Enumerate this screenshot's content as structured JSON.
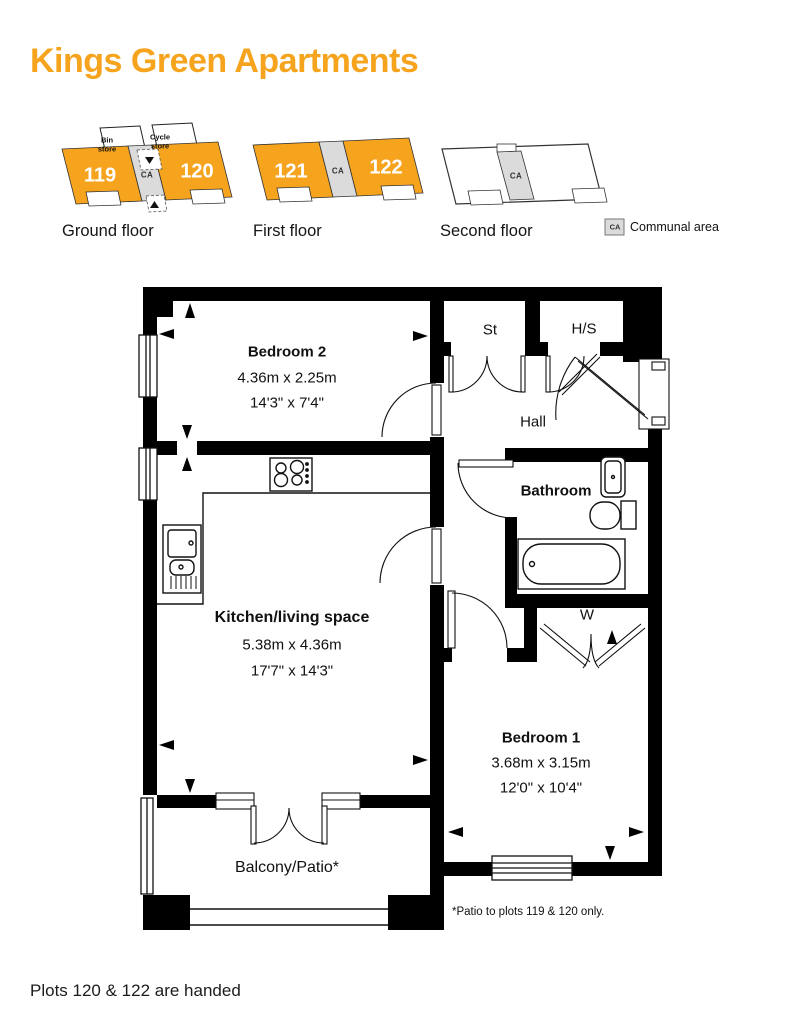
{
  "title": "Kings Green Apartments",
  "colors": {
    "accent": "#F6A41E",
    "communal": "#DBDBDB",
    "wall": "#000000"
  },
  "floor_key": {
    "ground": {
      "label": "Ground floor",
      "plot_left": "119",
      "plot_right": "120",
      "ca": "CA",
      "bin_store": "Bin store",
      "cycle_store": "Cycle store"
    },
    "first": {
      "label": "First floor",
      "plot_left": "121",
      "plot_right": "122",
      "ca": "CA"
    },
    "second": {
      "label": "Second floor",
      "ca": "CA"
    }
  },
  "legend": {
    "ca": "CA",
    "label": "Communal area"
  },
  "plan": {
    "bedroom2": {
      "name": "Bedroom 2",
      "metric": "4.36m x 2.25m",
      "imperial": "14'3\" x 7'4\""
    },
    "st": "St",
    "hs": "H/S",
    "hall": "Hall",
    "bathroom": "Bathroom",
    "w": "W",
    "kitchen": {
      "name": "Kitchen/living space",
      "metric": "5.38m x 4.36m",
      "imperial": "17'7\" x 14'3\""
    },
    "bedroom1": {
      "name": "Bedroom 1",
      "metric": "3.68m x 3.15m",
      "imperial": "12'0\" x 10'4\""
    },
    "balcony": "Balcony/Patio*",
    "note": "*Patio to plots 119 & 120 only."
  },
  "footer": "Plots 120 & 122 are handed"
}
